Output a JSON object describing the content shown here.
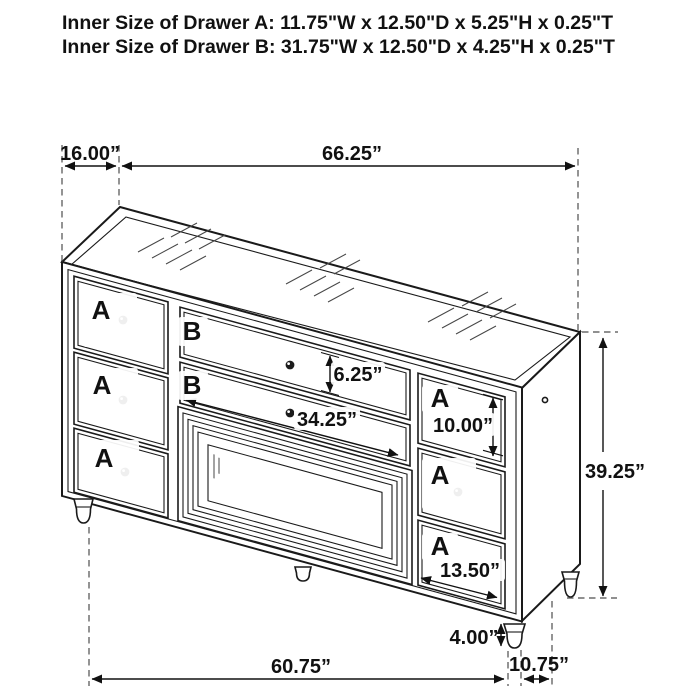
{
  "header": {
    "line1": "Inner Size of Drawer A: 11.75\"W x 12.50\"D x 5.25\"H x 0.25\"T",
    "line2": "Inner Size of Drawer B: 31.75\"W x 12.50\"D x 4.25\"H x 0.25\"T"
  },
  "drawers": {
    "a_label": "A",
    "b_label": "B"
  },
  "dims": {
    "top_depth": "16.00”",
    "top_width": "66.25”",
    "b_height": "6.25”",
    "b_width": "34.25”",
    "a_height": "10.00”",
    "overall_height": "39.25”",
    "a_width": "13.50”",
    "leg_height": "4.00”",
    "base_width": "60.75”",
    "base_depth": "10.75”"
  },
  "colors": {
    "drawer_label_red": "#ed1c24",
    "line": "#1a1a1a",
    "dash_gray": "#4d4d4d",
    "background": "#ffffff"
  }
}
